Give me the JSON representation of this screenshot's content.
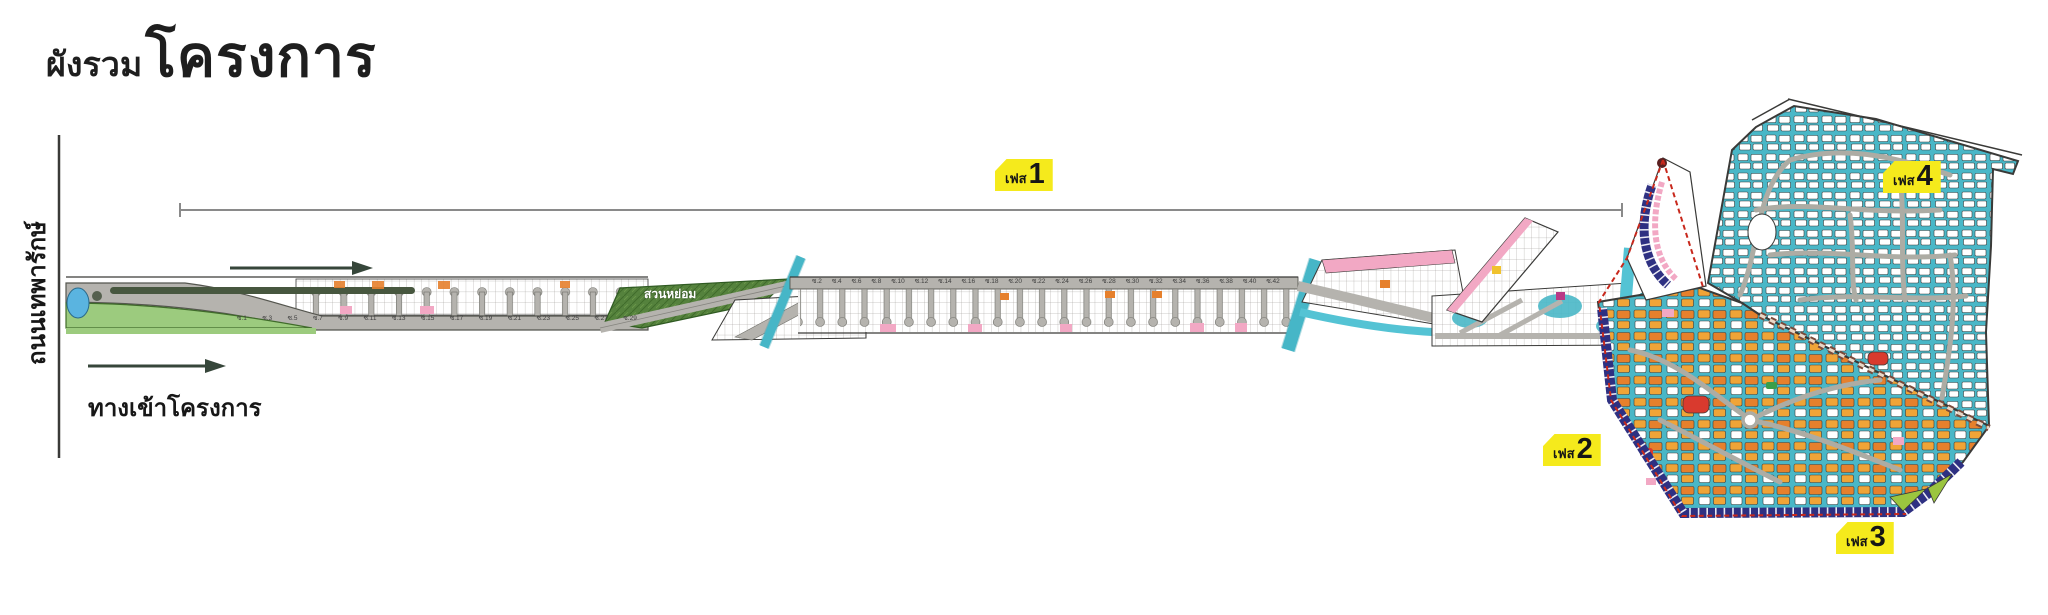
{
  "title": {
    "small": "ผังรวม",
    "large": "โครงการ"
  },
  "labels": {
    "road": "ถนนเทพารักษ์",
    "entrance": "ทางเข้าโครงการ",
    "garden": "สวนหย่อม"
  },
  "phases": {
    "p1": {
      "prefix": "เฟส",
      "number": "1"
    },
    "p2": {
      "prefix": "เฟส",
      "number": "2"
    },
    "p3": {
      "prefix": "เฟส",
      "number": "3"
    },
    "p4": {
      "prefix": "เฟส",
      "number": "4"
    }
  },
  "soi": {
    "top": [
      "ซ.2",
      "ซ.4",
      "ซ.6",
      "ซ.8",
      "ซ.10",
      "ซ.12",
      "ซ.14",
      "ซ.16",
      "ซ.18",
      "ซ.20",
      "ซ.22",
      "ซ.24",
      "ซ.26",
      "ซ.28",
      "ซ.30",
      "ซ.32",
      "ซ.34",
      "ซ.36",
      "ซ.38",
      "ซ.40",
      "ซ.42"
    ],
    "bottom": [
      "ซ.1",
      "ซ.3",
      "ซ.5",
      "ซ.7",
      "ซ.9",
      "ซ.11",
      "ซ.13",
      "ซ.15",
      "ซ.17",
      "ซ.19",
      "ซ.21",
      "ซ.23",
      "ซ.25",
      "ซ.27",
      "ซ.29"
    ]
  },
  "colors": {
    "phase_tag": "#f5ea1c",
    "cluster_teal": "#49b7c7",
    "navy_lots": "#2e3082",
    "orange_lots": "#e6802c",
    "amber_lots": "#f0a437",
    "red_lots": "#d93a2e",
    "pink_lots": "#f2a8c4",
    "road_gray": "#b5b3ae",
    "entrance_green": "#9ccb7e",
    "garden_green": "#55823d",
    "canal_cyan": "#54c3d4",
    "boundary_red": "#c8281c",
    "lime_green": "#9bc53f"
  }
}
